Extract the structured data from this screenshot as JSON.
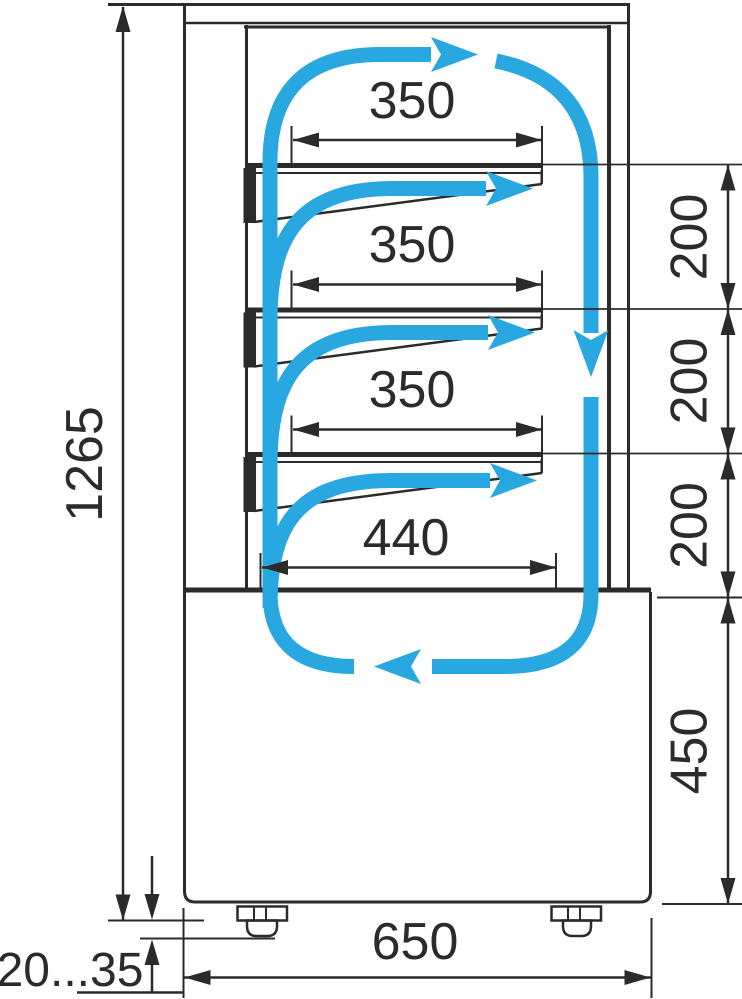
{
  "diagram": {
    "description": "Side cross-section drawing of a vertical refrigerated display case with air circulation arrows",
    "colors": {
      "line": "#2b2b2b",
      "airflow": "#29a7e0",
      "background": "#ffffff"
    },
    "dimensions": {
      "overall_height": "1265",
      "shelf_depth_1": "350",
      "shelf_depth_2": "350",
      "shelf_depth_3": "350",
      "bottom_shelf_depth": "440",
      "shelf_spacing_1": "200",
      "shelf_spacing_2": "200",
      "shelf_spacing_3": "200",
      "base_height": "450",
      "overall_depth": "650",
      "foot_height_range": "20...35"
    }
  }
}
